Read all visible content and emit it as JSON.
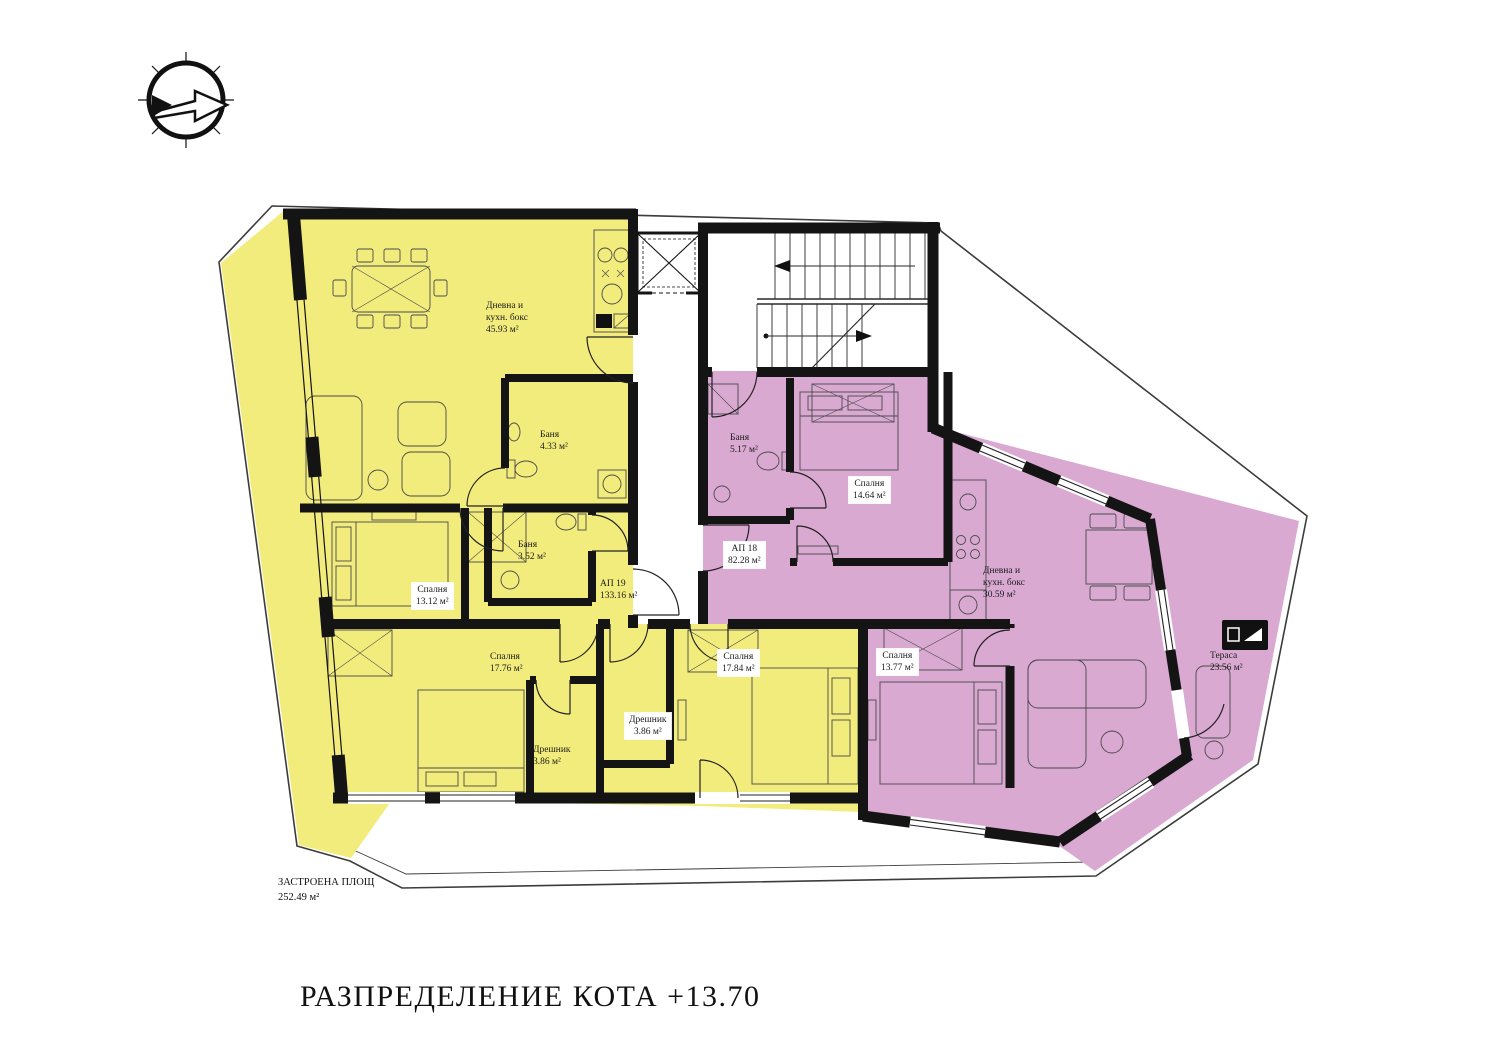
{
  "title": "РАЗПРЕДЕЛЕНИЕ КОТА +13.70",
  "built_area": {
    "line1": "ЗАСТРОЕНА ПЛОЩ",
    "line2": "252.49 м²"
  },
  "colors": {
    "apartment_19_fill": "#F2EC7C",
    "apartment_18_fill": "#D9A9D1",
    "walls": "#141414"
  },
  "icons": {
    "compass": "north-arrow",
    "terrace_sign": "terrace-sign"
  },
  "labels": {
    "living19": {
      "l1": "Дневна и",
      "l2": "кухн. бокс",
      "l3": "45.93 м²"
    },
    "bath19a": {
      "l1": "Баня",
      "l2": "4.33 м²"
    },
    "bath19b": {
      "l1": "Баня",
      "l2": "3.52 м²"
    },
    "ap19": {
      "l1": "АП 19",
      "l2": "133.16 м²"
    },
    "bed19a": {
      "l1": "Спалня",
      "l2": "13.12 м²"
    },
    "bed19b": {
      "l1": "Спалня",
      "l2": "17.76 м²"
    },
    "bed19c": {
      "l1": "Спалня",
      "l2": "17.84 м²"
    },
    "closet19a": {
      "l1": "Дрешник",
      "l2": "3.86 м²"
    },
    "closet19b": {
      "l1": "Дрешник",
      "l2": "3.86 м²"
    },
    "bath18": {
      "l1": "Баня",
      "l2": "5.17 м²"
    },
    "bed18a": {
      "l1": "Спалня",
      "l2": "14.64 м²"
    },
    "ap18": {
      "l1": "АП 18",
      "l2": "82.28 м²"
    },
    "living18": {
      "l1": "Дневна и",
      "l2": "кухн. бокс",
      "l3": "30.59 м²"
    },
    "bed18b": {
      "l1": "Спалня",
      "l2": "13.77 м²"
    },
    "terrace18": {
      "l1": "Тераса",
      "l2": "23.56 м²"
    }
  }
}
